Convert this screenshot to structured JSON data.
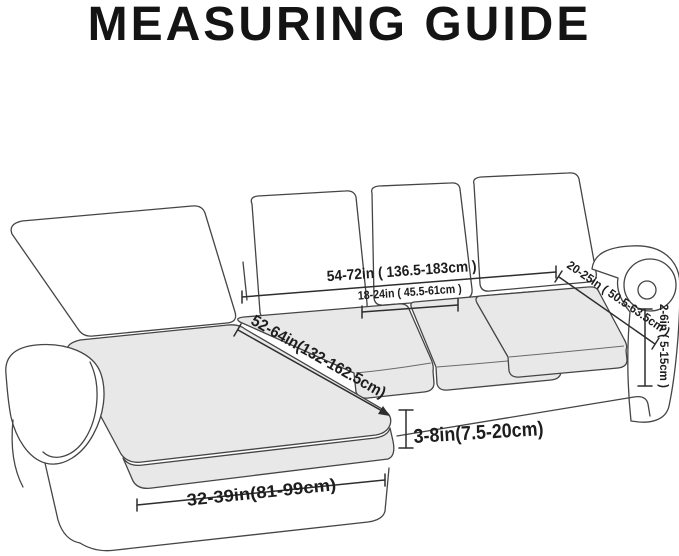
{
  "title": "MEASURING GUIDE",
  "diagram": {
    "type": "sofa-sectional-measuring-diagram",
    "measurements": {
      "back_section_width": "54-72in ( 136.5-183cm )",
      "back_cushion_width": "18-24in ( 45.5-61cm )",
      "arm_top_length": "20-25in ( 50.5-63.5cm )",
      "arm_side_height": "2-6in ( 5-15cm )",
      "chaise_length": "52-64in(132-162.5cm)",
      "seat_front_height": "3-8in(7.5-20cm)",
      "chaise_width": "32-39in(81-99cm)"
    },
    "colors": {
      "background": "#ffffff",
      "outline": "#454545",
      "cushion_fill": "#e8e8e8",
      "title_text": "#141414",
      "label_text": "#1d1d1d"
    }
  }
}
